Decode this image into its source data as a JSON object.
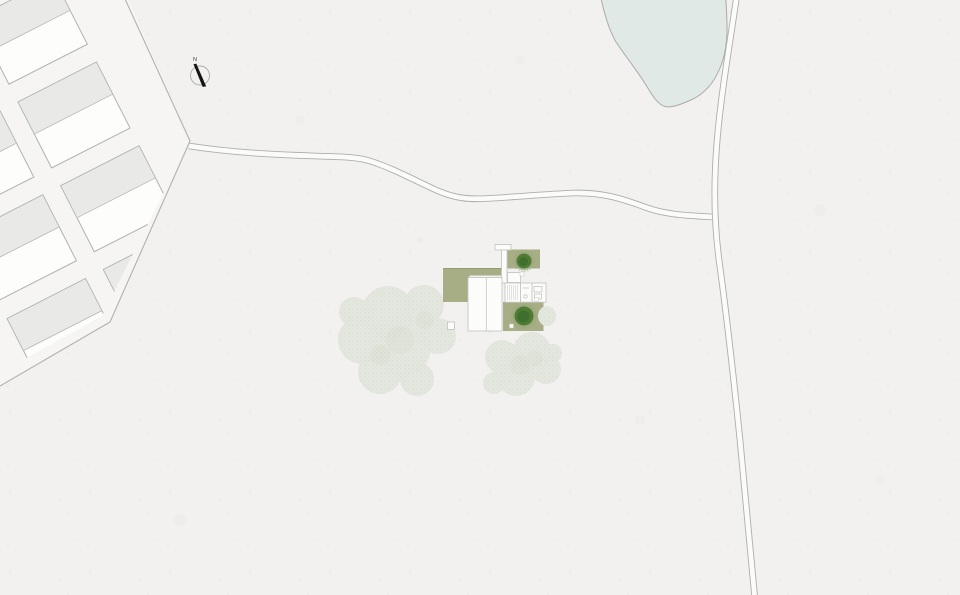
{
  "document": {
    "type": "architectural-site-plan",
    "title": "Site plan"
  },
  "compass": {
    "label": "N"
  },
  "features": [
    {
      "name": "housing-estate",
      "kind": "plot-grid",
      "visible_blocks": 8
    },
    {
      "name": "country-road",
      "kind": "road"
    },
    {
      "name": "north-south-road",
      "kind": "road"
    },
    {
      "name": "pond",
      "kind": "water"
    },
    {
      "name": "house",
      "kind": "building-roof-plan"
    },
    {
      "name": "garden-terraces",
      "kind": "paved-green"
    },
    {
      "name": "garden-trees",
      "kind": "trees"
    },
    {
      "name": "field-tree-clusters",
      "kind": "trees"
    },
    {
      "name": "north-arrow",
      "kind": "symbol"
    }
  ],
  "colors": {
    "paper": "#f2f1ef",
    "speckle": "#e7e6e3",
    "speckle2": "#eceae7",
    "street": "#f6f5f3",
    "plotline": "#b1b1af",
    "blockwhite": "#fdfdfc",
    "blockgray": "#e9e9e7",
    "pond": "#e0e9e6",
    "pondline": "#a9aba7",
    "roadline": "#aeaeac",
    "roadfill": "#fbfbfa",
    "canopy": "#e4e7df",
    "canopydot": "#ccd2c3",
    "canopyshade": "#dbe0d4",
    "terrace": "#a7ad84",
    "terracedark": "#949c6e",
    "roofwhite": "#fcfcfa",
    "roofline": "#c6c6c4",
    "wallline": "#b4b4b2",
    "treedark": "#3f6f2f",
    "treemid": "#4f7b33",
    "treeedge": "#9aaa80",
    "needle": "#151515"
  }
}
